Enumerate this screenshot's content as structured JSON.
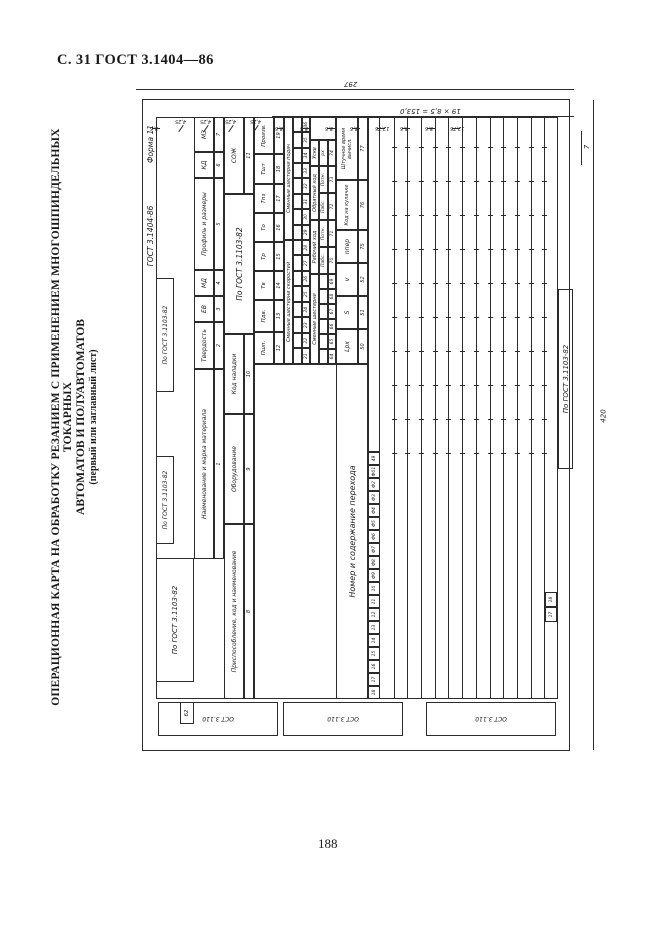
{
  "page": {
    "header": "С. 31 ГОСТ 3.1404—86",
    "page_number": "188",
    "side_title_line1": "ОПЕРАЦИОННАЯ КАРТА НА ОБРАБОТКУ РЕЗАНИЕМ С ПРИМЕНЕНИЕМ МНОГОШПИНДЕЛЬНЫХ ТОКАРНЫХ",
    "side_title_line2": "АВТОМАТОВ И ПОЛУАВТОМАТОВ",
    "side_title_line3": "(первый или заглавный лист)"
  },
  "form": {
    "standard": "ГОСТ 3.1404-86",
    "form_no": "Форма 11",
    "gost_ref": "По ГОСТ 3.1103-82",
    "corner_num": "62",
    "dims": {
      "overall_width": "297",
      "row_grid": "19 × 8,5 = 153,0",
      "top_row_h": "7",
      "overall_height": "420",
      "top_segments": [
        "8,5",
        "4,25",
        "4,25",
        "4,25",
        "4,25",
        "8,5",
        "8,5",
        "8,5",
        "8,5",
        "12,75",
        "8,5",
        "8,5",
        "12,75"
      ]
    },
    "top_boxes": [
      "По ГОСТ 3.1103-82",
      "По ГОСТ 3.1103-82",
      "По ГОСТ 3.1103-82"
    ],
    "margin_boxes": [
      "По ГОСТ 3.1103-82",
      "По ГОСТ 3.1103-82",
      "По ГОСТ 3.1103-82"
    ],
    "header_row1": [
      {
        "label": "Наименование и марка материала",
        "num": "1"
      },
      {
        "label": "Твердость",
        "num": "2"
      },
      {
        "label": "ЕВ",
        "num": "3"
      },
      {
        "label": "МД",
        "num": "4"
      },
      {
        "label": "Профиль и размеры",
        "num": "5"
      },
      {
        "label": "КД",
        "num": "6"
      },
      {
        "label": "МЗ",
        "num": "7"
      }
    ],
    "header_row2": [
      {
        "label": "Приспособление, код и наименование",
        "num": "8"
      },
      {
        "label": "Оборудование",
        "num": "9"
      },
      {
        "label": "Код наладки",
        "num": "10"
      },
      {
        "label": "По ГОСТ 3.1103-82",
        "num": ""
      },
      {
        "label": "СОЖ",
        "num": "11"
      }
    ],
    "header_row3": [
      {
        "label": "Пшп.",
        "num": "12"
      },
      {
        "label": "Пдв.",
        "num": "13"
      },
      {
        "label": "Тв",
        "num": "14"
      },
      {
        "label": "Тр",
        "num": "15"
      },
      {
        "label": "То",
        "num": "16"
      },
      {
        "label": "Тпз",
        "num": "17"
      },
      {
        "label": "Тшт",
        "num": "18"
      },
      {
        "label": "Произв.",
        "num": "19"
      }
    ],
    "gear_groups": [
      {
        "label": "Сменные шестерни скоростей",
        "nums": [
          "21",
          "22",
          "23",
          "24",
          "25",
          "26",
          "27",
          "28"
        ]
      },
      {
        "label": "Сменные шестерни подач",
        "nums": [
          "29",
          "30",
          "31",
          "32",
          "33",
          "34",
          "35",
          "36"
        ]
      }
    ],
    "row5": {
      "gears": {
        "label": "Сменные шестерни",
        "nums": [
          "64",
          "65",
          "66",
          "67",
          "68",
          "69"
        ]
      },
      "work": {
        "label": "Рабочий ход",
        "cells": [
          [
            "Пабс.",
            "70"
          ],
          [
            "Потн.",
            "71"
          ]
        ]
      },
      "back": {
        "label": "Обратный ход",
        "cells": [
          [
            "Пабс.",
            "72"
          ],
          [
            "Потн.",
            "73"
          ]
        ]
      },
      "fast": {
        "label": "Ускв",
        "cells": [
          [
            "рх",
            "74"
          ]
        ]
      }
    },
    "row6": {
      "left_label": "Номер и содержание перехода",
      "cells": [
        [
          "Lрх",
          "50"
        ],
        [
          "S",
          "51"
        ],
        [
          "v",
          "52"
        ],
        [
          "nпер",
          "75"
        ],
        [
          "Код на кулачке",
          "76"
        ],
        [
          "Штучное время вычисл.",
          "77"
        ]
      ]
    },
    "line_numbers": [
      "18",
      "17",
      "16",
      "15",
      "14",
      "13",
      "12",
      "11",
      "10",
      "Ф9",
      "Ф8",
      "Ф7",
      "Ф6",
      "Ф5",
      "Ф4",
      "Ф3",
      "Ф2",
      "Ф01",
      "49"
    ],
    "bottom_cells": [
      "17",
      "18"
    ],
    "title_block": "По ГОСТ 3.1103-82"
  }
}
